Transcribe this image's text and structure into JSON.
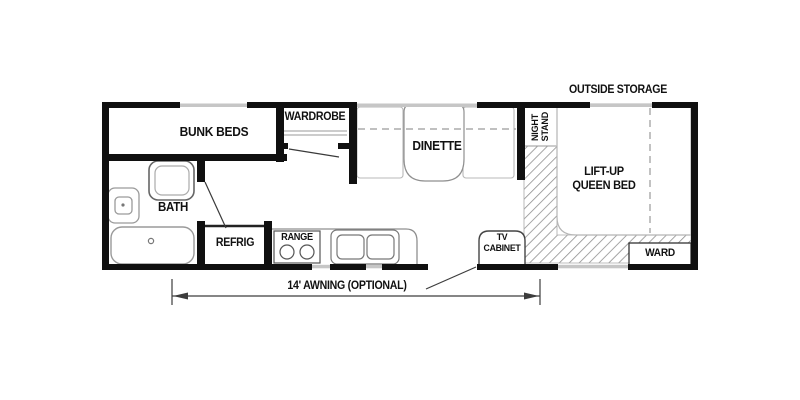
{
  "title": "Travel trailer floor plan",
  "colors": {
    "wall": "#101010",
    "window_line": "#c6c6c6",
    "fixture_outline": "#8f8f8f",
    "hatch": "#8f8f8f",
    "text": "#111111"
  },
  "rooms": {
    "bunk_beds": "BUNK BEDS",
    "wardrobe": "WARDROBE",
    "dinette": "DINETTE",
    "bath": "BATH",
    "refrig": "REFRIG",
    "range": "RANGE",
    "night_stand": {
      "line1": "NIGHT",
      "line2": "STAND"
    },
    "queen_bed": {
      "line1": "LIFT-UP",
      "line2": "QUEEN BED"
    },
    "tv_cabinet": {
      "line1": "TV",
      "line2": "CABINET"
    },
    "ward": "WARD",
    "outside_storage": "OUTSIDE STORAGE"
  },
  "dimension": {
    "awning_label": "14' AWNING (OPTIONAL)"
  }
}
